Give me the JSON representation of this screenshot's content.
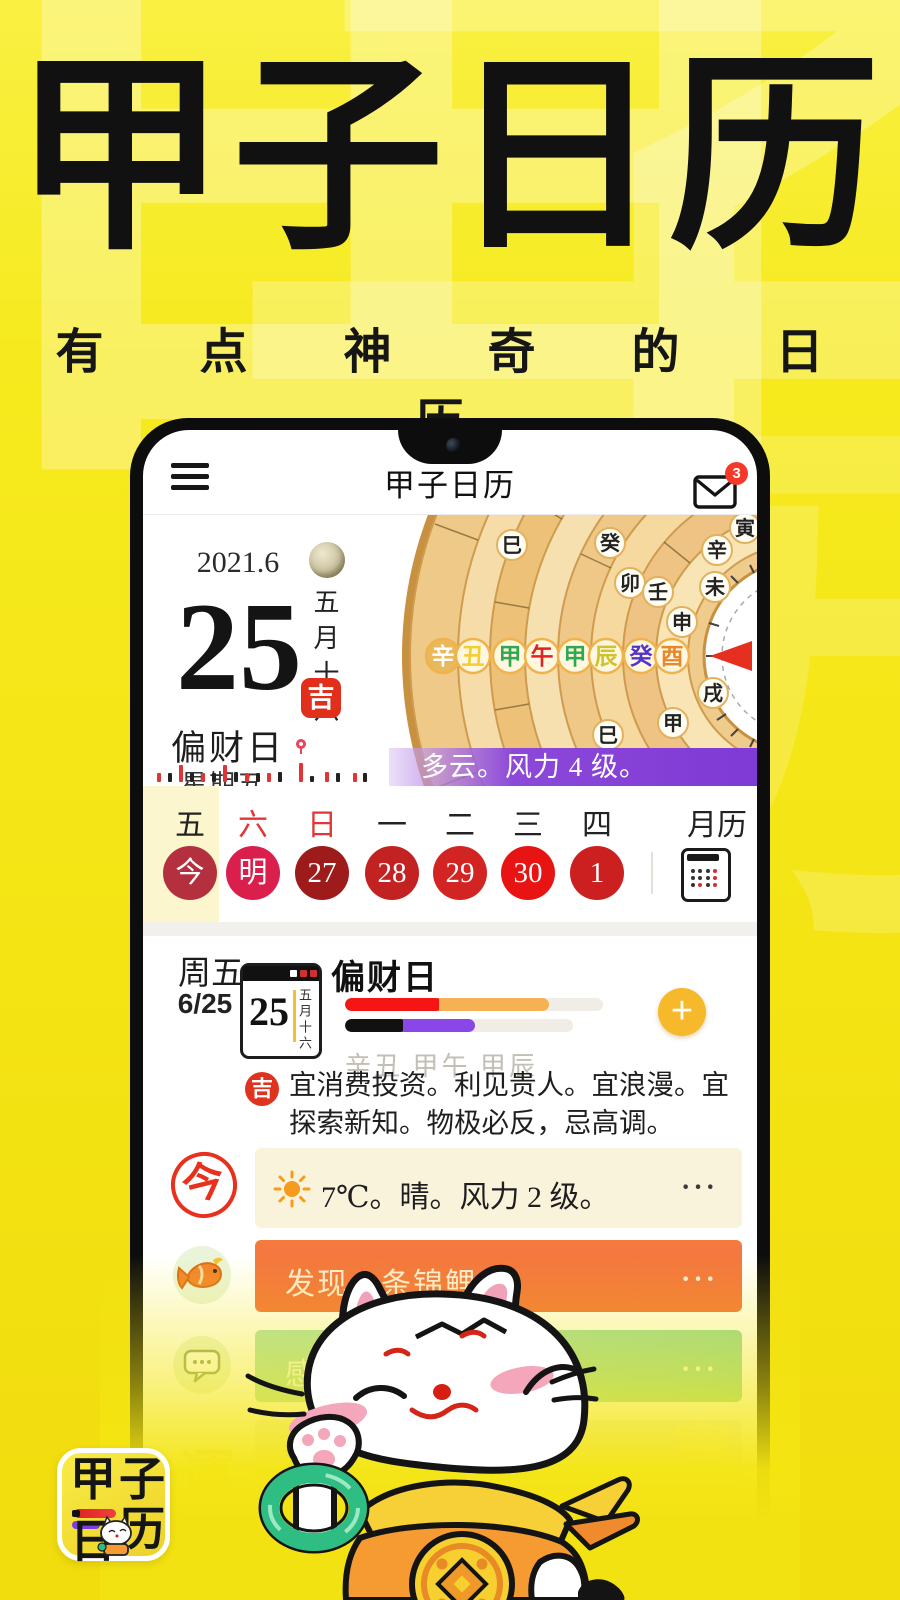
{
  "hero": {
    "title": "甲子日历",
    "subtitle": "有 点 神 奇 的 日 历"
  },
  "watermark": {
    "w1": "甲",
    "w2": "子",
    "w3": "历"
  },
  "app": {
    "header": {
      "title": "甲子日历",
      "badge_count": "3"
    },
    "today_panel": {
      "year_month": "2021.6",
      "day": "25",
      "lunar_date": "五月十六",
      "fortune_label": "偏财日",
      "luck_badge": "吉",
      "weekday": "星期五"
    },
    "wheel": {
      "h0": "辛",
      "h1": "丑",
      "h2": "甲",
      "h3": "午",
      "h4": "甲",
      "h5": "辰",
      "h6": "癸",
      "h7": "酉",
      "a0": "巳",
      "a1": "癸",
      "a2": "卯",
      "a3": "壬",
      "a4": "申",
      "a5": "未",
      "a6": "辛",
      "a7": "寅",
      "a8": "巳",
      "a9": "甲",
      "a10": "戌"
    },
    "weather_banner": {
      "text": "多云。风力 4 级。"
    },
    "week": {
      "d0": "五",
      "d1": "六",
      "d2": "日",
      "d3": "一",
      "d4": "二",
      "d5": "三",
      "d6": "四",
      "month_view": "月历",
      "c0": "今",
      "c1": "明",
      "c2": "27",
      "c3": "28",
      "c4": "29",
      "c5": "30",
      "c6": "1"
    },
    "detail": {
      "weekday": "周五",
      "date": "6/25",
      "card_day": "25",
      "card_lunar": "五月十六",
      "fortune_title": "偏财日",
      "ganzhi": "辛丑 甲午 甲辰",
      "luck_badge": "吉",
      "advice": "宜消费投资。利见贵人。宜浪漫。宜探索新知。物极必反，忌高调。"
    },
    "rows": {
      "today_stamp": "今",
      "weather_text": "7℃。晴。风力 2 级。",
      "koi_text": "发现一条锦鲤。",
      "insight_text": "感悟",
      "tip_text": "提",
      "more": "···"
    },
    "faded_marks": {
      "m1": "運",
      "m2": "寶",
      "m3": "事"
    }
  },
  "logo": {
    "c1": "甲",
    "c2": "子",
    "c3": "日",
    "c4": "历"
  },
  "palette": {
    "background": "#F5E718",
    "banner_purple": "#7F39D6",
    "koi_orange": "#F3713E",
    "insight_green": "#93D8A4",
    "cream_card": "#FAF3DC",
    "accent_red": "#E0331F",
    "gold_button": "#F6B92B",
    "bar_red": "#F51515",
    "bar_orange": "#F6B154",
    "bar_black": "#111111",
    "bar_purple": "#8B46E8"
  }
}
